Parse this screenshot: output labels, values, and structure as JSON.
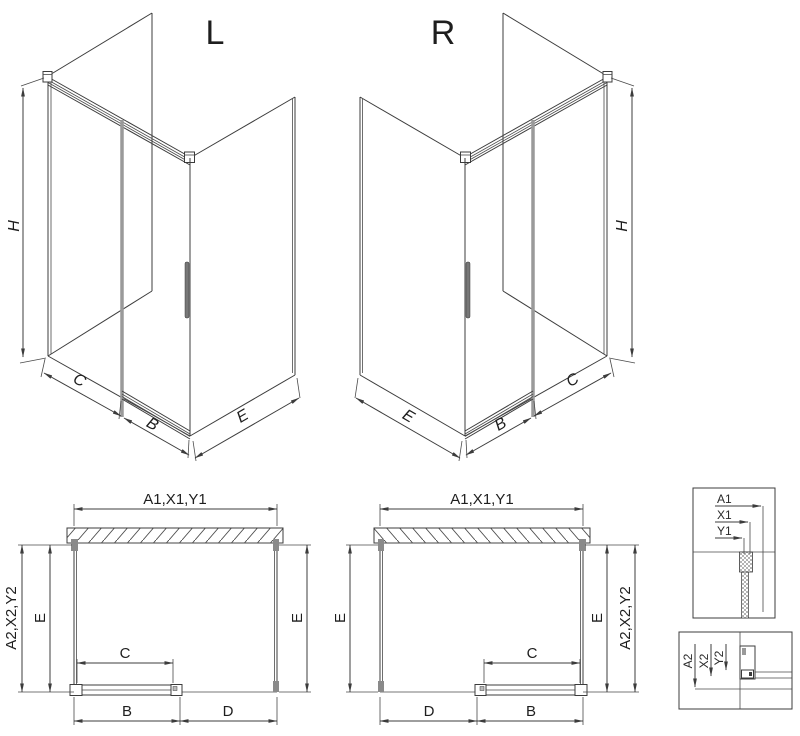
{
  "iso_l": {
    "title": "L",
    "dim_h": "H",
    "dim_c": "C",
    "dim_b": "B",
    "dim_e": "E"
  },
  "iso_r": {
    "title": "R",
    "dim_h": "H",
    "dim_c": "C",
    "dim_b": "B",
    "dim_e": "E"
  },
  "plan_l": {
    "dim_top": "A1,X1,Y1",
    "dim_left_outer": "A2,X2,Y2",
    "dim_left_inner": "E",
    "dim_right": "E",
    "dim_c": "C",
    "dim_b": "B",
    "dim_d": "D"
  },
  "plan_r": {
    "dim_top": "A1,X1,Y1",
    "dim_left": "E",
    "dim_right_inner": "E",
    "dim_right_outer": "A2,X2,Y2",
    "dim_c": "C",
    "dim_b": "B",
    "dim_d": "D"
  },
  "detail_top": {
    "dim_a1": "A1",
    "dim_x1": "X1",
    "dim_y1": "Y1"
  },
  "detail_bottom": {
    "dim_a2": "A2",
    "dim_x2": "X2",
    "dim_y2": "Y2"
  },
  "colors": {
    "line": "#3c3c3c",
    "door_profile": "#9a9a9a",
    "text": "#1e1e1e",
    "background": "#ffffff"
  }
}
